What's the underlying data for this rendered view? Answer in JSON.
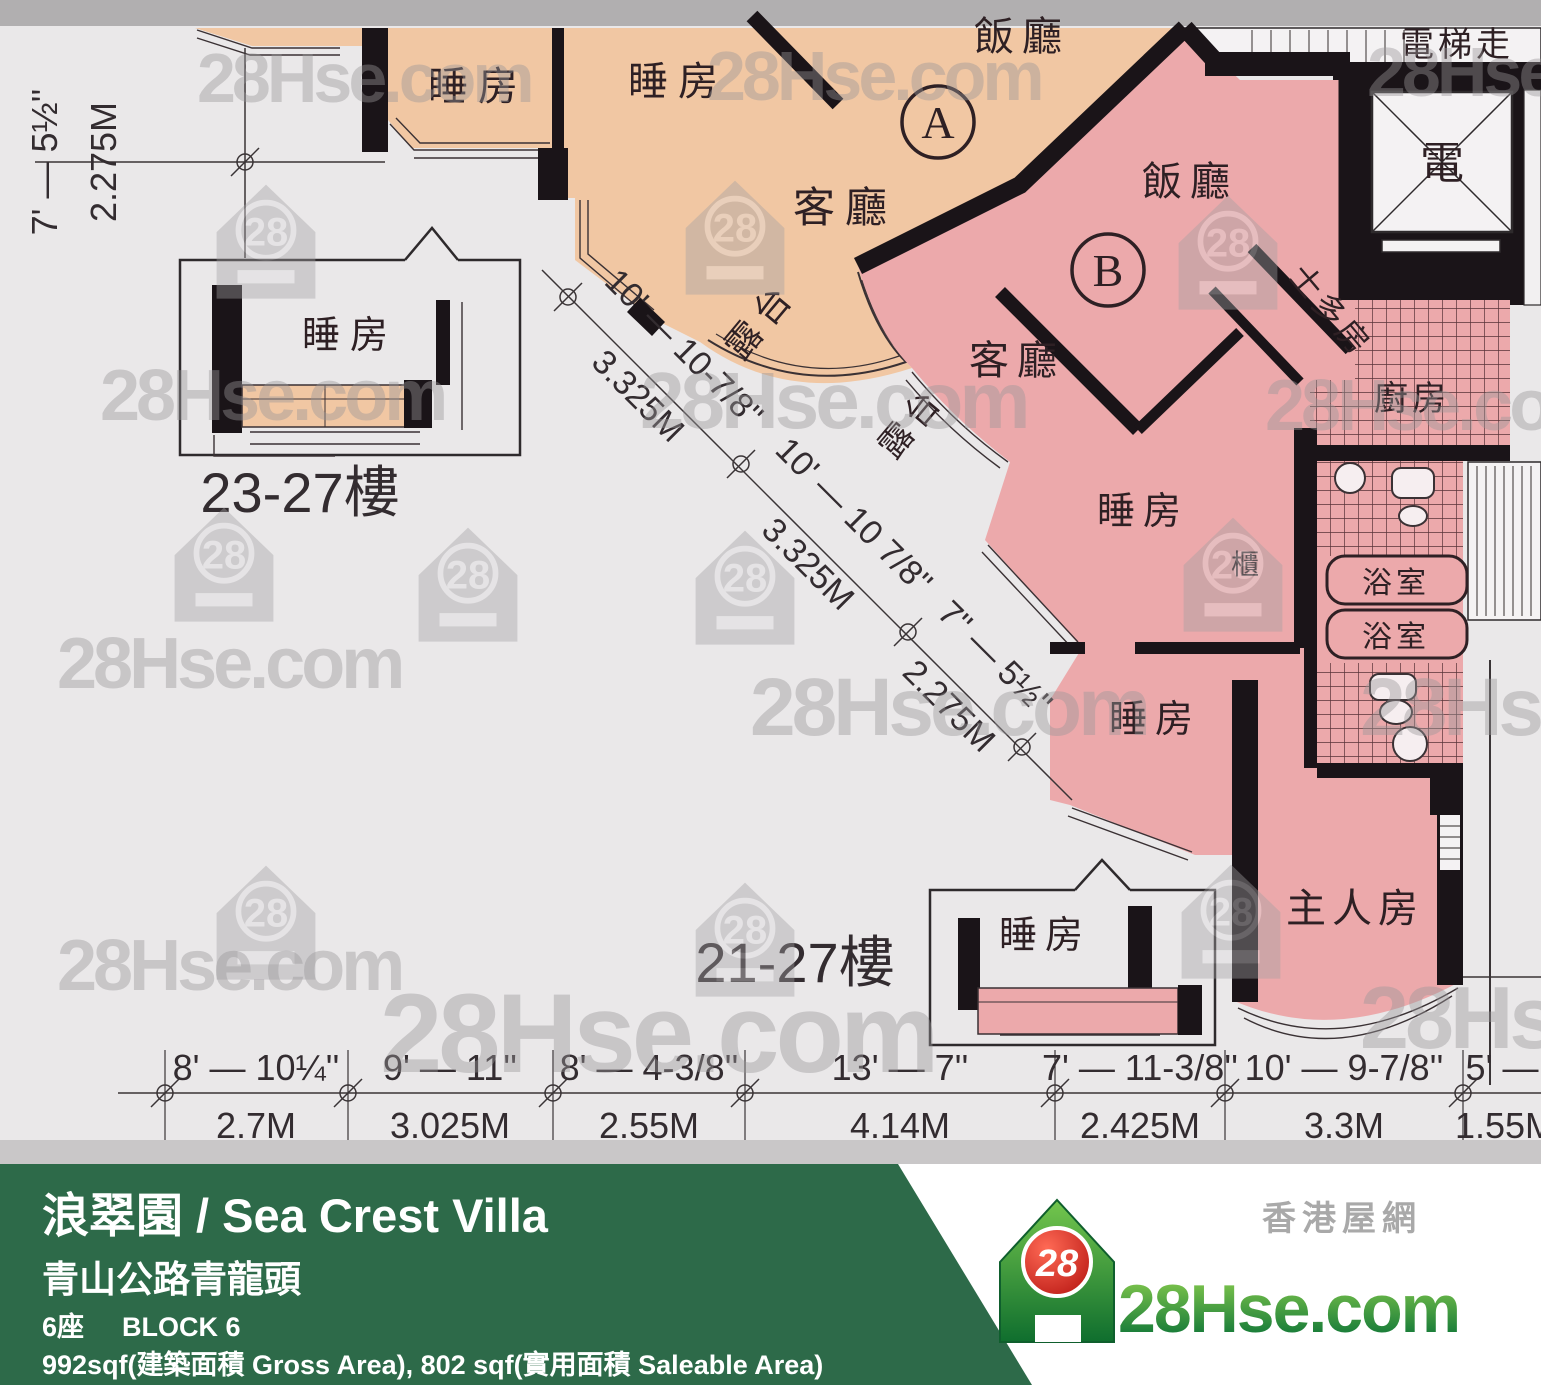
{
  "watermark": {
    "brand": "28Hse.com",
    "badge": "28"
  },
  "colors": {
    "unit_a_fill": "#f1c7a3",
    "unit_b_fill": "#eca9ab",
    "footer_green": "#2d6a49",
    "logo_red": "#d9251c",
    "logo_green": "#157a35",
    "paper": "#eae8e9"
  },
  "plan": {
    "units": {
      "a": "A",
      "b": "B"
    },
    "floor_tags": {
      "upper": "23-27樓",
      "lower": "21-27樓"
    },
    "rooms": {
      "bedroom": "睡房",
      "living": "客廳",
      "dining": "飯廳",
      "balcony": "露台",
      "master": "主人房",
      "kitchen": "廚房",
      "store": "士多房",
      "bathroom": "浴室",
      "cabinet": "櫃",
      "electrical": "電",
      "lift_lobby": "電梯走"
    },
    "dims": {
      "left": {
        "ft": "7' — 5½''",
        "m": "2.275M"
      },
      "diagonal": [
        {
          "ft": "10' — 10-7/8''",
          "m": "3.325M"
        },
        {
          "ft": "10' — 10 7/8''",
          "m": "3.325M"
        },
        {
          "ft": "7'' — 5½''",
          "m": "2.275M"
        }
      ],
      "bottom": [
        {
          "ft": "8' — 10¼''",
          "m": "2.7M"
        },
        {
          "ft": "9' — 11''",
          "m": "3.025M"
        },
        {
          "ft": "8' — 4-3/8''",
          "m": "2.55M"
        },
        {
          "ft": "13' — 7''",
          "m": "4.14M"
        },
        {
          "ft": "7' — 11-3/8''",
          "m": "2.425M"
        },
        {
          "ft": "10' — 9-7/8''",
          "m": "3.3M"
        },
        {
          "ft": "5' —",
          "m": "1.55M"
        }
      ]
    }
  },
  "footer": {
    "title": "浪翠園 / Sea Crest Villa",
    "address": "青山公路青龍頭",
    "block_zh": "6座",
    "block_en": "BLOCK 6",
    "area": "992sqf(建築面積 Gross Area), 802 sqf(實用面積 Saleable Area)"
  },
  "logo": {
    "brand": "28Hse.com",
    "badge": "28",
    "tagline": "香港屋網"
  }
}
